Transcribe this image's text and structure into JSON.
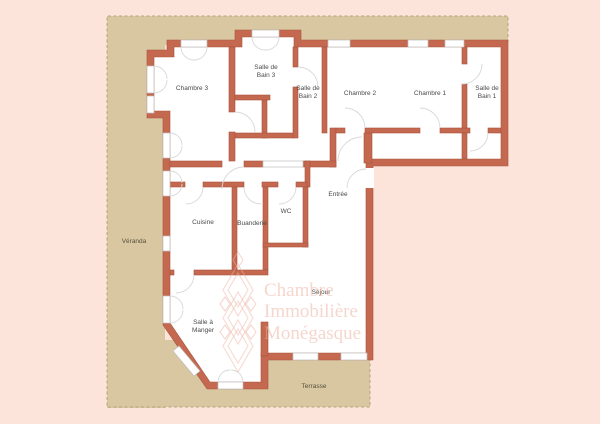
{
  "rooms": {
    "chambre_3": {
      "label": "Chambre 3"
    },
    "salle_de_bain_3": {
      "line1": "Salle de",
      "line2": "Bain 3"
    },
    "salle_de_bain_2": {
      "line1": "Salle de",
      "line2": "Bain 2"
    },
    "chambre_2": {
      "label": "Chambre 2"
    },
    "chambre_1": {
      "label": "Chambre 1"
    },
    "salle_de_bain_1": {
      "line1": "Salle de",
      "line2": "Bain 1"
    },
    "cuisine": {
      "label": "Cuisine"
    },
    "buanderie": {
      "label": "Buanderie"
    },
    "wc": {
      "label": "WC"
    },
    "entree": {
      "label": "Entrée"
    },
    "sejour": {
      "label": "Séjour"
    },
    "salle_a_manger": {
      "line1": "Salle à",
      "line2": "Manger"
    }
  },
  "outdoor": {
    "veranda": {
      "label": "Véranda"
    },
    "terrasse": {
      "label": "Terrasse"
    }
  },
  "watermark": {
    "line1": "Chambre",
    "line2": "Immobilière",
    "line3": "Monégasque"
  },
  "colors": {
    "background": "#fce4da",
    "outdoor": "#d8c7a0",
    "wall": "#c4694f",
    "room": "#ffffff"
  }
}
